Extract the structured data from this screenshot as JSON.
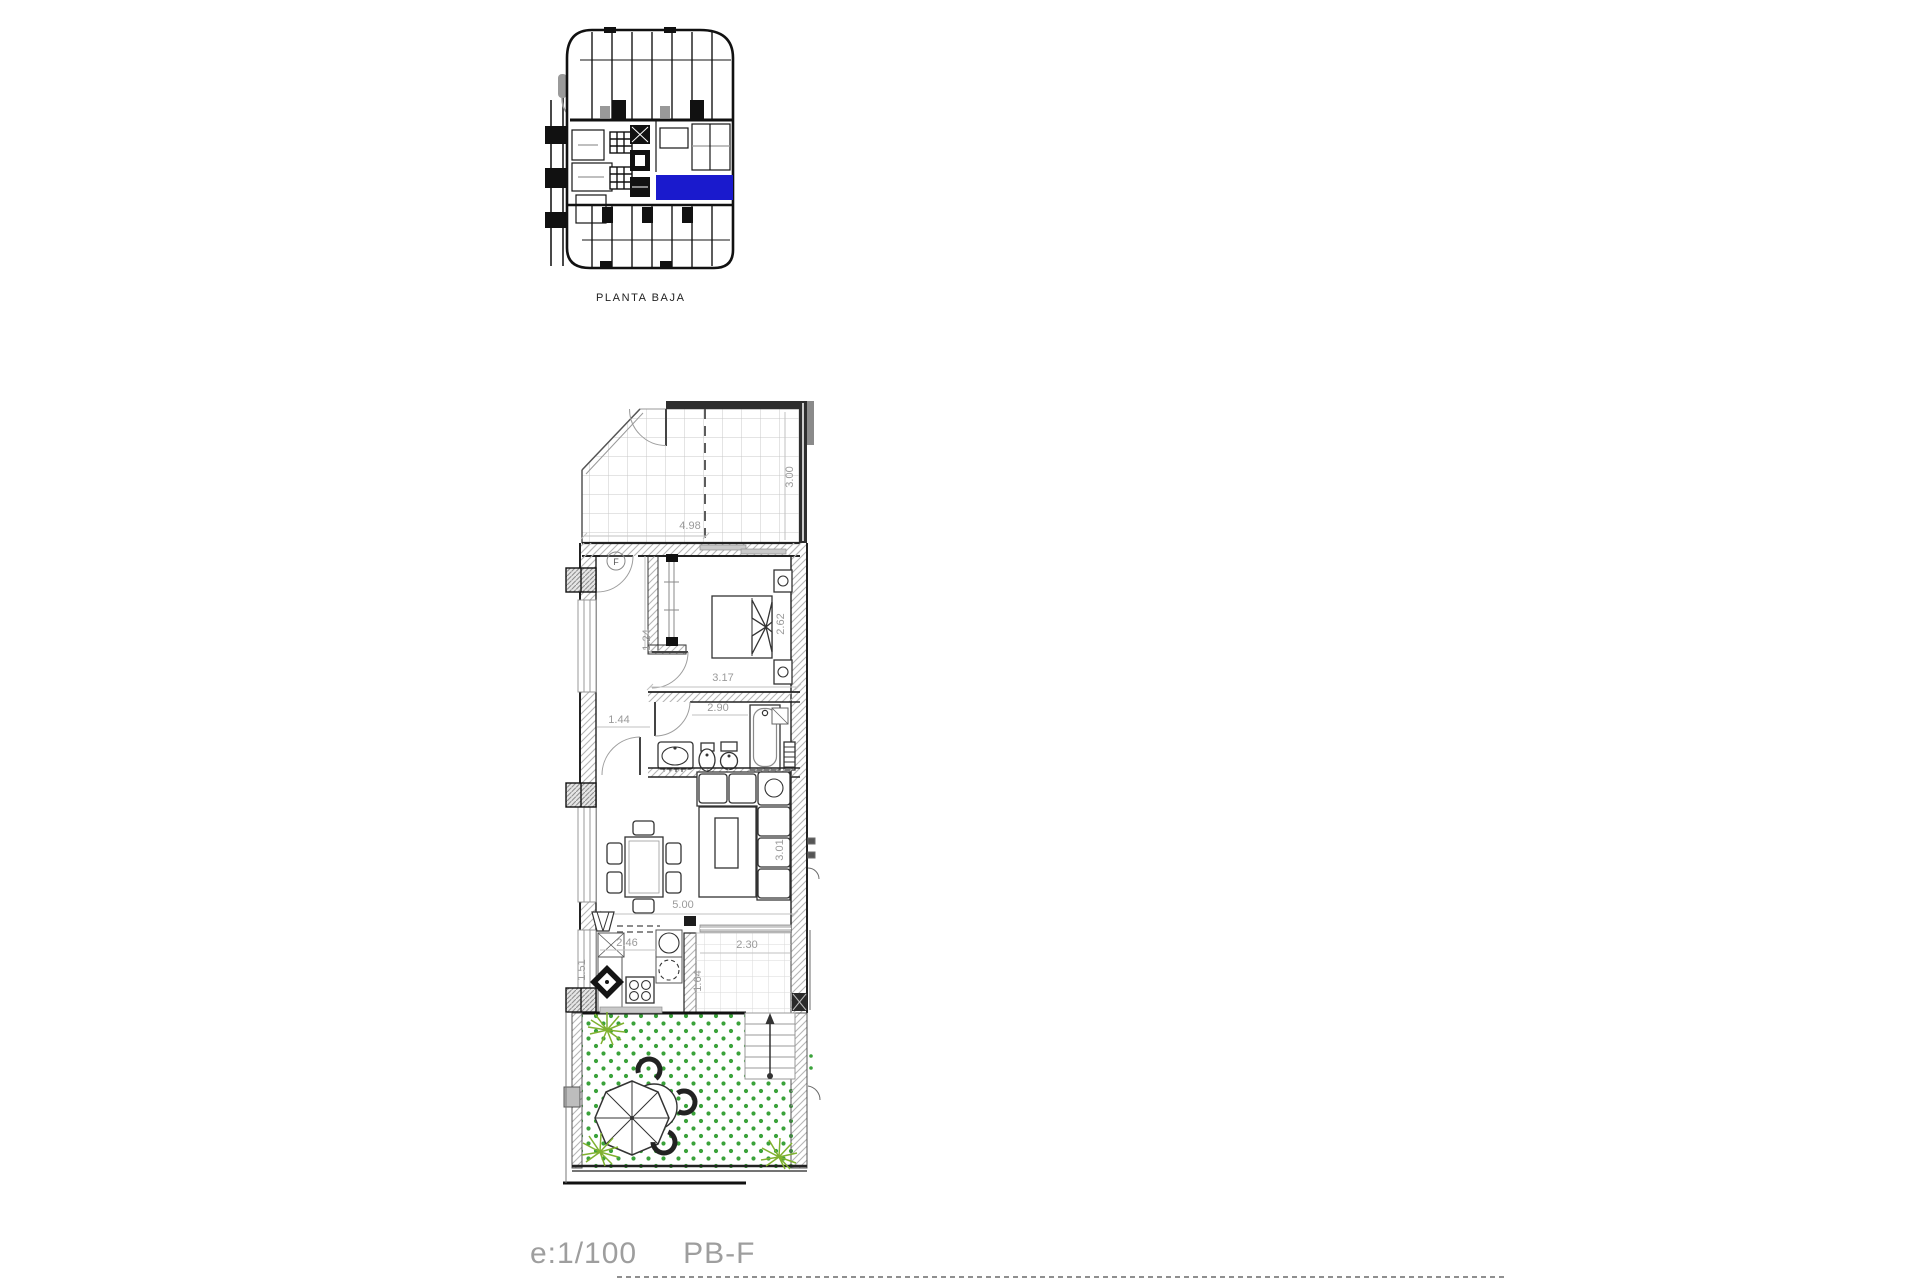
{
  "colors": {
    "highlight_blue": "#1a1acd",
    "grass_green": "#3aa23a",
    "plant_green": "#7fb12f",
    "dim_gray": "#9a9a9a"
  },
  "site_plan": {
    "label": "PLANTA BAJA"
  },
  "floor_plan": {
    "hall_symbol": "F",
    "dimensions": {
      "terrace_width": "4.98",
      "terrace_depth": "3.00",
      "bedroom_width": "3.17",
      "bedroom_depth": "2.62",
      "wardrobe_depth": "1.24",
      "bathroom_width": "2.90",
      "hall_width": "1.44",
      "living_width": "5.00",
      "living_depth": "3.01",
      "kitchen_width": "2.46",
      "kitchen_depth": "1.51",
      "stairs_width": "2.30",
      "stairs_depth": "1.64"
    }
  },
  "footer": {
    "scale": "e:1/100",
    "plan_code": "PB-F"
  }
}
